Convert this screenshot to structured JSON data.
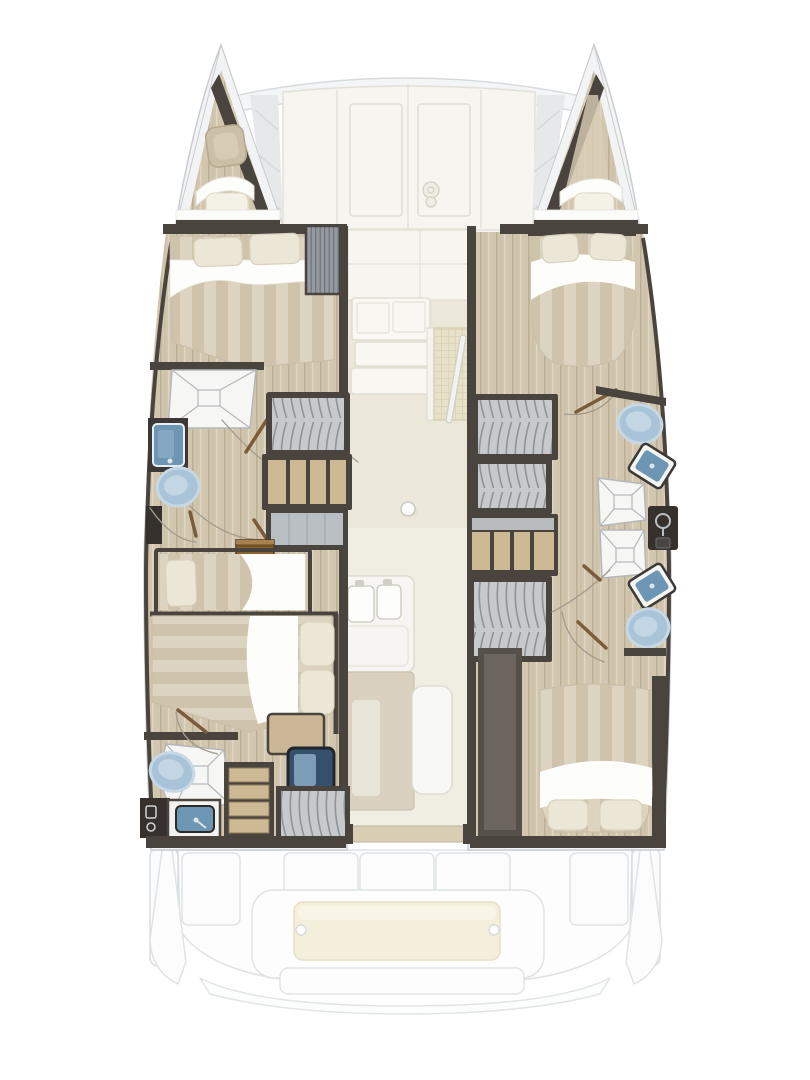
{
  "document": {
    "type": "yacht-floor-plan",
    "subject": "catamaran interior layout, top-down view, bow at top",
    "text_labels": []
  },
  "palette": {
    "bg": "#ffffff",
    "ghost": "#f3f4f6",
    "ghost-line": "#c9cdd0",
    "panel": "#f6f5f0",
    "panel-line": "#e1e0d8",
    "wood": "#d2c6ae",
    "wall": "#4a443f",
    "wall-deep": "#36312c",
    "saloon-a": "#ebe7d9",
    "saloon-b": "#f0ede2",
    "duvet-a": "#dcd3c0",
    "duvet-b": "#cfc4ab",
    "pillow": "#ece6d6",
    "sheet": "#fdfdfb",
    "locker": "#c6cacd",
    "locker-line": "#8e9499",
    "shelf": "#cdb994",
    "steps": "#8a6331",
    "fixture": "#a9c4d8",
    "fixture-rim": "#c6d8e4",
    "basin": "#6d96b4",
    "shower": "#f6f6f4",
    "shower-line": "#b3b7ba",
    "mat": "#e8e1c9",
    "mat-line": "#d2c8aa",
    "tan": "#d9d0c0",
    "cream": "#f3efdb",
    "door-leaf": "#7b5c3a",
    "door-arc": "#a39b8d",
    "marble": "#e6e8ea"
  },
  "legend": {
    "hulls": [
      "port",
      "starboard"
    ],
    "cabins": [
      {
        "id": "port-forward-cabin",
        "berth": "double",
        "pillows": 2
      },
      {
        "id": "port-aft-cabin",
        "berth": "double",
        "pillows": 2
      },
      {
        "id": "port-aft-single-berth",
        "berth": "single",
        "pillows": 1
      },
      {
        "id": "starboard-forward-cabin",
        "berth": "double",
        "pillows": 2
      },
      {
        "id": "starboard-aft-cabin",
        "berth": "double",
        "pillows": 2
      }
    ],
    "bathrooms": [
      {
        "id": "port-mid-head",
        "fixtures": [
          "shower",
          "sink",
          "toilet"
        ]
      },
      {
        "id": "port-aft-head",
        "fixtures": [
          "shower",
          "sink",
          "toilet"
        ]
      },
      {
        "id": "starboard-forward-head",
        "fixtures": [
          "shower",
          "sink",
          "toilet"
        ]
      },
      {
        "id": "starboard-aft-head",
        "fixtures": [
          "shower",
          "sink",
          "toilet"
        ]
      }
    ],
    "forepeaks": [
      {
        "id": "port-forepeak",
        "items": [
          "hatch",
          "step",
          "cushion"
        ]
      },
      {
        "id": "starboard-forepeak",
        "items": [
          "step",
          "cushion"
        ]
      }
    ],
    "saloon": [
      "galley-cabinets",
      "galley-island-twin-sinks",
      "grid-hatch",
      "mast-step",
      "tall-cabinet",
      "bench"
    ],
    "storage": [
      "hanging-locker x5",
      "shelf-unit x2",
      "louvered-locker",
      "drawer-stack",
      "companionway-steps"
    ],
    "foredeck": [
      "crossbeam",
      "lounge-panels",
      "windlass"
    ],
    "cockpit": [
      "seat-backs x3",
      "side-console x2",
      "aft-bench",
      "swim-platform",
      "transom-steps"
    ]
  }
}
